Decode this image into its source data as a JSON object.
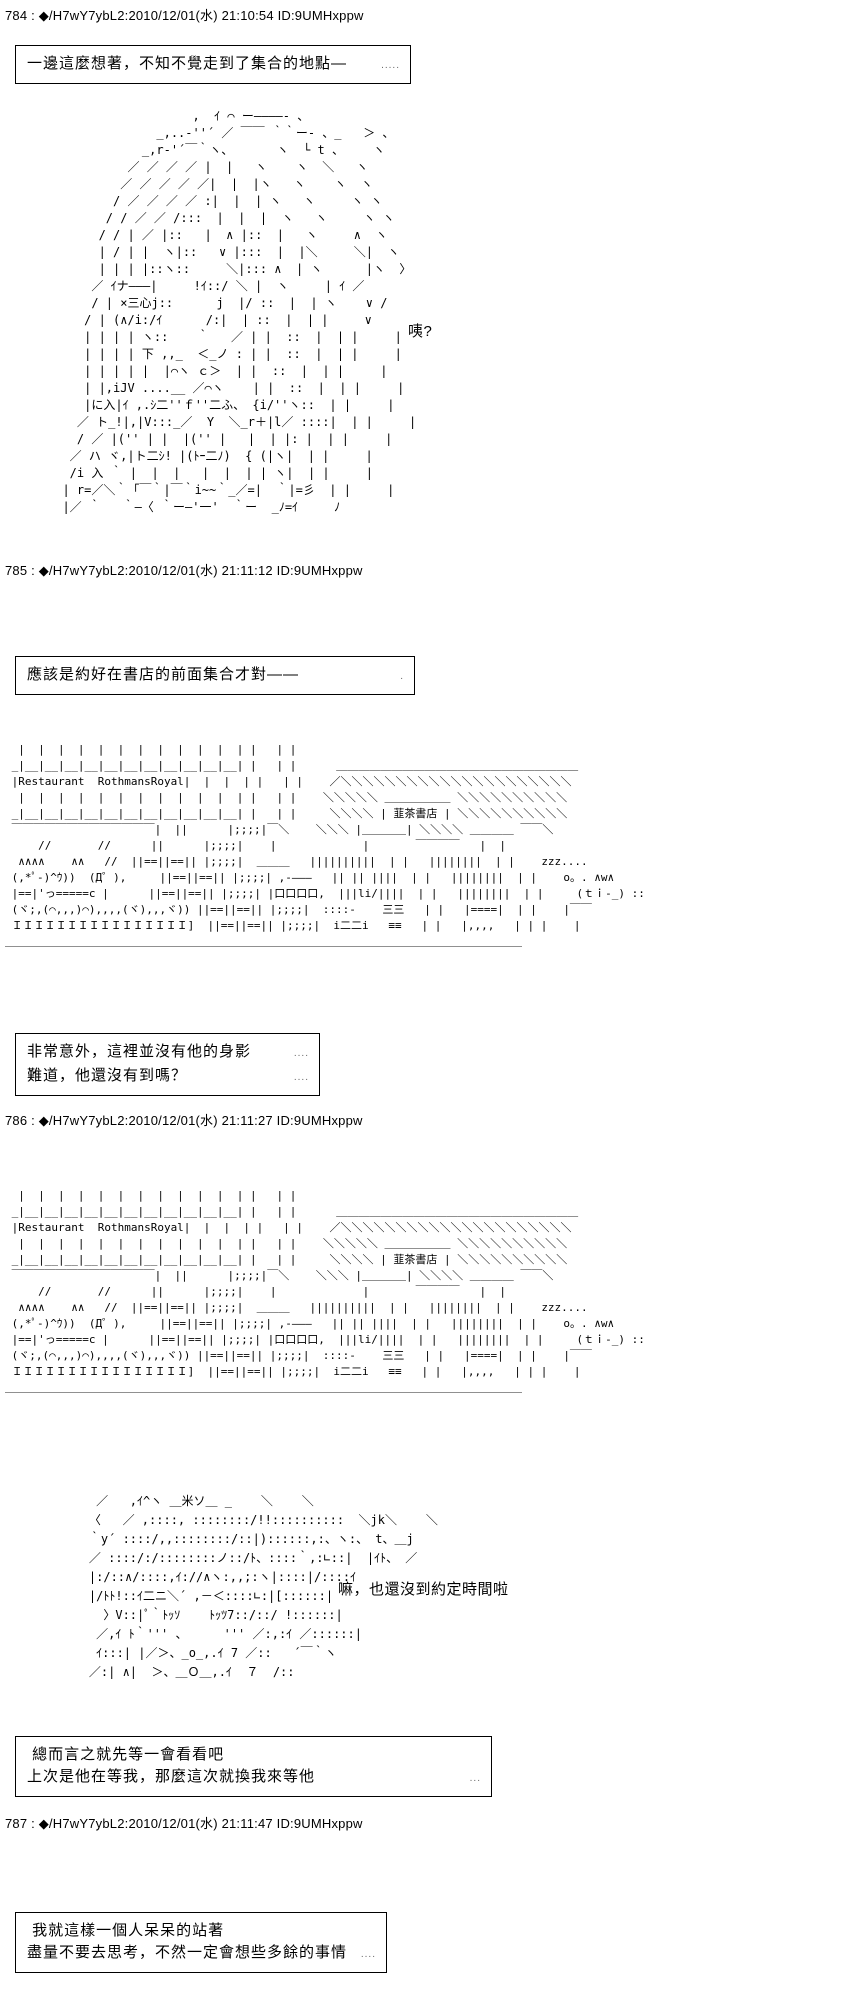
{
  "page": {
    "background": "#ffffff",
    "text_color": "#000000"
  },
  "posts": {
    "p784": {
      "header": "784 : ◆/H7wY7ybL2:2010/12/01(水) 21:10:54 ID:9UMHxppw"
    },
    "p785": {
      "header": "785 : ◆/H7wY7ybL2:2010/12/01(水) 21:11:12 ID:9UMHxppw"
    },
    "p786": {
      "header": "786 : ◆/H7wY7ybL2:2010/12/01(水) 21:11:27 ID:9UMHxppw"
    },
    "p787": {
      "header": "787 : ◆/H7wY7ybL2:2010/12/01(水) 21:11:47 ID:9UMHxppw"
    }
  },
  "boxes": {
    "box1": {
      "line1": "一邊這麼想著，不知不覺走到了集合的地點—",
      "trail1": "....."
    },
    "box2": {
      "line1": "應該是約好在書店的前面集合才對——",
      "trail1": "."
    },
    "box3": {
      "line1": "非常意外，這裡並沒有他的身影",
      "trail1": "....",
      "line2": "難道，他還沒有到嗎？",
      "trail2": "...."
    },
    "box4": {
      "line1": " 總而言之就先等一會看看吧",
      "trail1": "",
      "line2": "上次是他在等我，那麼這次就換我來等他",
      "trail2": "..."
    },
    "box5": {
      "line1": " 我就這樣一個人呆呆的站著",
      "trail1": "",
      "line2": "盡量不要去思考，不然一定會想些多餘的事情",
      "trail2": "...."
    }
  },
  "speech": {
    "surprised": "咦?",
    "not_yet_time": "嘛，也還沒到約定時間啦"
  },
  "ascii_art": {
    "arrival_girl": "                    ,  ｲ ⌒ ー――――- 、\n               _,..-''´ ／ ￣￣ ｀｀ー- 、_   ＞ 、\n             _,r‐'´￣｀ヽ、      ヽ  └ t 、    ヽ\n           ／ ／ ／ ／ |  |   ヽ    ヽ  ＼   ヽ\n          ／ ／ ／ ／ ／|  |  |ヽ   ヽ    ヽ  ヽ\n         / ／ ／ ／ ／ :|  |  | ヽ   ヽ     ヽ ヽ\n        / / ／ ／ /:::  |  |  |  ヽ   ヽ     ヽ ヽ\n       / / | ／ |::   |  ∧ |::  |   ヽ     ∧  ヽ\n       | / | |  ヽ|::   ∨ |:::  |  |＼     ＼|  ヽ\n       | | | |::ヽ::     ＼|::: ∧  | ヽ      |ヽ  〉\n      ／ ｲナ―――|     !ｲ::/ ＼ |  ヽ     | ｲ ／\n      / | ×三心j::      j  |/ ::  |  | ヽ    ∨ /\n     / | (∧/i:/ｲ      /:|  | ::  |  | |     ∨\n     | | | | ヽ::    ｀   ／ | |  ::  |  | |     |\n     | | | | 下 ,,_  ＜_ノ : | |  ::  |  | |     |\n     | | | | |  |⌒ヽ ｃ＞  | |  ::  |  | |     |\n     | |,iJV ....__ ／⌒ヽ    | |  ::  |  | |     |\n     |に入|ｲ ,.ｼ二''ｆ''二ふ、 {i/''ヽ::  | |     |\n    ／ ト_!|,|V:::_／  Y  ＼_r＋|l／ ::::|  | |     |\n    / ／ |('' | |  |('' |   |  | |: |  | |     |\n   ／ ハ ヾ,|ト二ｼ! |(ﾄｰ二ﾉ)  { (|ヽ|  | |     |\n   /i 入 ｀ |  |  |   |  |  | | ヽ|  | |     |\n  | r=／＼｀「￣｀|￣｀i~~｀_／=|  ｀|=彡  | |     |\n  |／ ｀   ｀―〈 ｀ー―'一'  ｀ー  _ﾉ=ｲ     ﾉ",
    "bookstore_street": "  |  |  |  |  |  |  |  |  |  |  |  | |   | |\n _|__|__|__|__|__|__|__|__|__|__|__| |   | |      ＿＿＿＿＿＿＿＿＿＿＿＿＿＿＿＿＿＿＿＿＿＿\n |Restaurant  RothmansRoyal|  |  |  | |   | |    ／＼＼＼＼＼＼＼＼＼＼＼＼＼＼＼＼＼＼＼＼＼\n  |  |  |  |  |  |  |  |  |  |  |  | |   | |    ＼＼＼＼＼ ＿＿＿＿＿＿ ＼＼＼＼＼＼＼＼＼＼\n _|__|__|__|__|__|__|__|__|__|__|__| |   | |     ＼＼＼＼ | 韮茶書店 | ＼＼＼＼＼＼＼＼＼＼\n ￣￣￣￣￣￣￣￣￣￣￣￣￣|  ||      |;;;;|￣＼    ＼＼＼ |＿＿＿＿| ＼＼＼＼ ＿＿＿＿ ￣￣＼\n     //       //      ||      |;;;;|    |             |       ￣￣￣￣   |  |\n  ∧∧∧∧    ∧∧   //  ||==||==|| |;;;;|  ＿＿＿   ||||||||||  | |   ||||||||  | |    zzz....\n (,*ﾟ-)^ｳ))  (Д゜),     ||==||==|| |;;;;| ,‐―――   || || ||||  | |   ||||||||  | |    o。. ∧w∧\n |==|'っ=====c |      ||==||==|| |;;;;| |口口口口,  |||li/||||  | |   ||||||||  | |     (ｔｉ-_) ::\n (ヾ;,(⌒,,,)⌒),,,,(ヾ),,,ヾ)) ||==||==|| |;;;;|  ::::‐    三三   | |   |====|  | |    |￣￣\n ＩＩＩＩＩＩＩＩＩＩＩＩＩＩＩＩ]  ||==||==|| |;;;;|  i二二i   ≡≡   | |   |,,,,   | | |    |\n＿＿＿＿＿＿＿＿＿＿＿＿＿＿＿＿＿＿＿＿＿＿＿＿＿＿＿＿＿＿＿＿＿＿＿＿＿＿＿＿＿＿＿＿＿＿＿",
    "waiting_girl": "     ／   ,ｲ^ヽ ＿米ソ＿ _    ＼    ＼\n    〈   ／ ,::::, ::::::::/!!::::::::::  ＼jk＼    ＼\n    ｀y´ ::::/,,::::::::/::|)::::::,:、ヽ:、 t、＿j\n    ／ ::::/:/::::::::ノ::/ﾄ、::::｀,:∟::|  |ｲﾄ、 ／\n    |:/::∧/::::,ｲ://∧ヽ:,,;:ヽ|::::|/::::ｲ\n    |/ﾄﾄ!::ｲ二ニ＼´ ,－＜::::∟:|[::::::|\n      〉V::|ﾟ｀ﾄｯｿ    ﾄｯﾂ7::/::/ !::::::|\n     ／,ｲ ﾄ｀''' 、     ''' ／:,:ｲ ／::::::|\n     ｲ:::| |／＞、_o_,.ｲ 7 ／::   ´￣｀ヽ\n    ／:| ∧|  ＞、＿Ｏ＿,.ｲ  ７  /::"
  }
}
